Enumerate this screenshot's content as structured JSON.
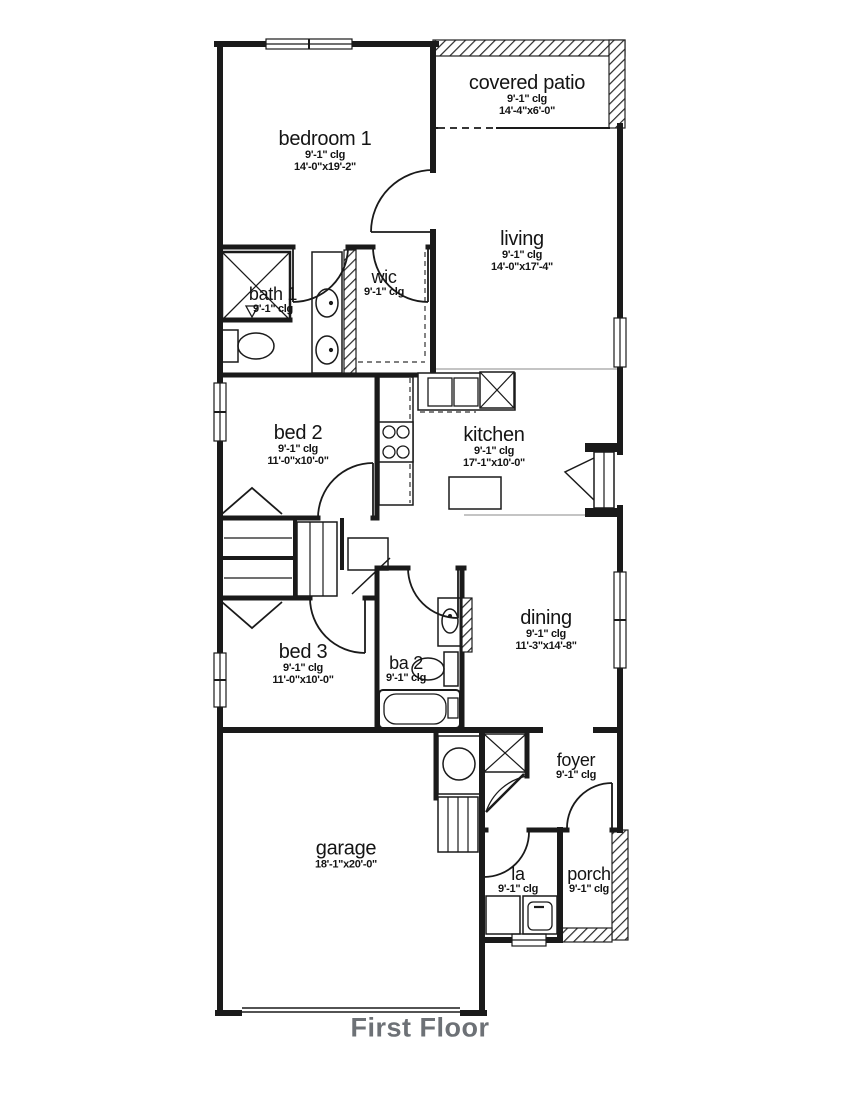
{
  "title": "First Floor",
  "colors": {
    "wall": "#1a1a1a",
    "title_text": "#6d7176",
    "hatch": "#2a2a2a",
    "background": "#ffffff"
  },
  "rooms": {
    "bedroom1": {
      "name": "bedroom 1",
      "clg": "9'-1\" clg",
      "dims": "14'-0\"x19'-2\""
    },
    "covered_patio": {
      "name": "covered patio",
      "clg": "9'-1\" clg",
      "dims": "14'-4\"x6'-0\""
    },
    "living": {
      "name": "living",
      "clg": "9'-1\" clg",
      "dims": "14'-0\"x17'-4\""
    },
    "bath1": {
      "name": "bath 1",
      "clg": "9'-1\" clg"
    },
    "wic": {
      "name": "wic",
      "clg": "9'-1\" clg"
    },
    "bed2": {
      "name": "bed 2",
      "clg": "9'-1\" clg",
      "dims": "11'-0\"x10'-0\""
    },
    "kitchen": {
      "name": "kitchen",
      "clg": "9'-1\" clg",
      "dims": "17'-1\"x10'-0\""
    },
    "dining": {
      "name": "dining",
      "clg": "9'-1\" clg",
      "dims": "11'-3\"x14'-8\""
    },
    "bed3": {
      "name": "bed 3",
      "clg": "9'-1\" clg",
      "dims": "11'-0\"x10'-0\""
    },
    "ba2": {
      "name": "ba 2",
      "clg": "9'-1\" clg"
    },
    "garage": {
      "name": "garage",
      "dims": "18'-1\"x20'-0\""
    },
    "foyer": {
      "name": "foyer",
      "clg": "9'-1\" clg"
    },
    "la": {
      "name": "la",
      "clg": "9'-1\" clg"
    },
    "porch": {
      "name": "porch",
      "clg": "9'-1\" clg"
    }
  }
}
